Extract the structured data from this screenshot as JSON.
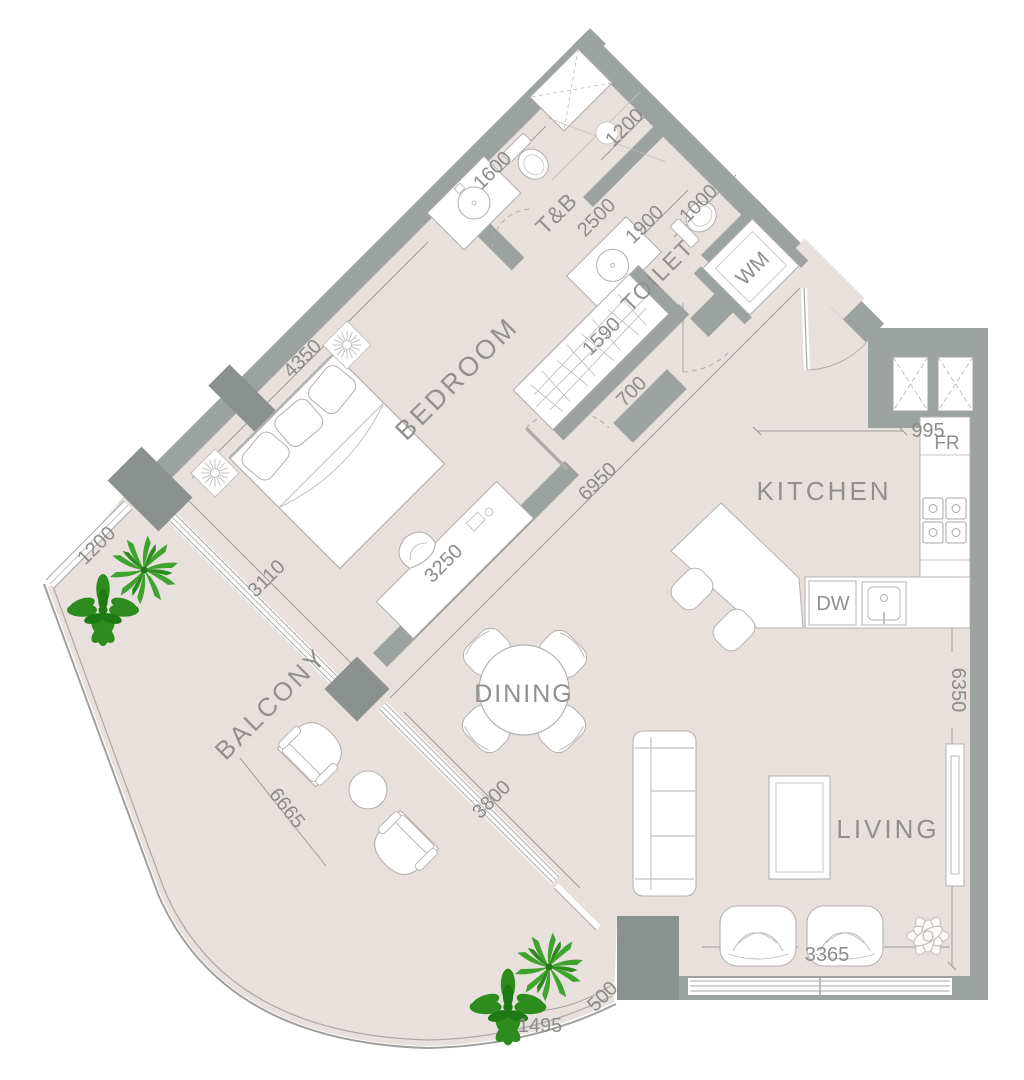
{
  "plan": {
    "title": "1-bedroom apartment floor plan",
    "labels": {
      "bedroom": "BEDROOM",
      "bath": "T&B",
      "toilet": "TOILET",
      "kitchen": "KITCHEN",
      "dining": "DINING",
      "living": "LIVING",
      "balcony": "BALCONY",
      "washing_machine": "WM",
      "fridge": "FR",
      "dishwasher": "DW"
    },
    "dimensions_mm": {
      "bath_top": "1200",
      "bath_side": "1600",
      "bath_length": "2500",
      "toilet_length": "1900",
      "toilet_width": "1000",
      "wardrobe_length": "1590",
      "wardrobe_depth": "700",
      "bedroom_length": "4350",
      "bedroom_depth": "3250",
      "bedroom_window": "3110",
      "hall_diagonal": "6950",
      "dining_window": "3800",
      "balcony_end": "1200",
      "balcony_length": "6665",
      "kitchen_clearance": "995",
      "kitchen_length": "6350",
      "living_width": "3365",
      "balcony_column": "500",
      "balcony_curve": "1495"
    },
    "colors": {
      "floor": "#e8e0dc",
      "wall": "#9ba29f",
      "wall_dark": "#8a918e",
      "furniture_line": "#b2b0ae",
      "label_text": "#90908e",
      "dimension_text": "#8c8c8a",
      "plant_green": "#3fa32f",
      "plant_dark": "#1e7a14"
    }
  }
}
